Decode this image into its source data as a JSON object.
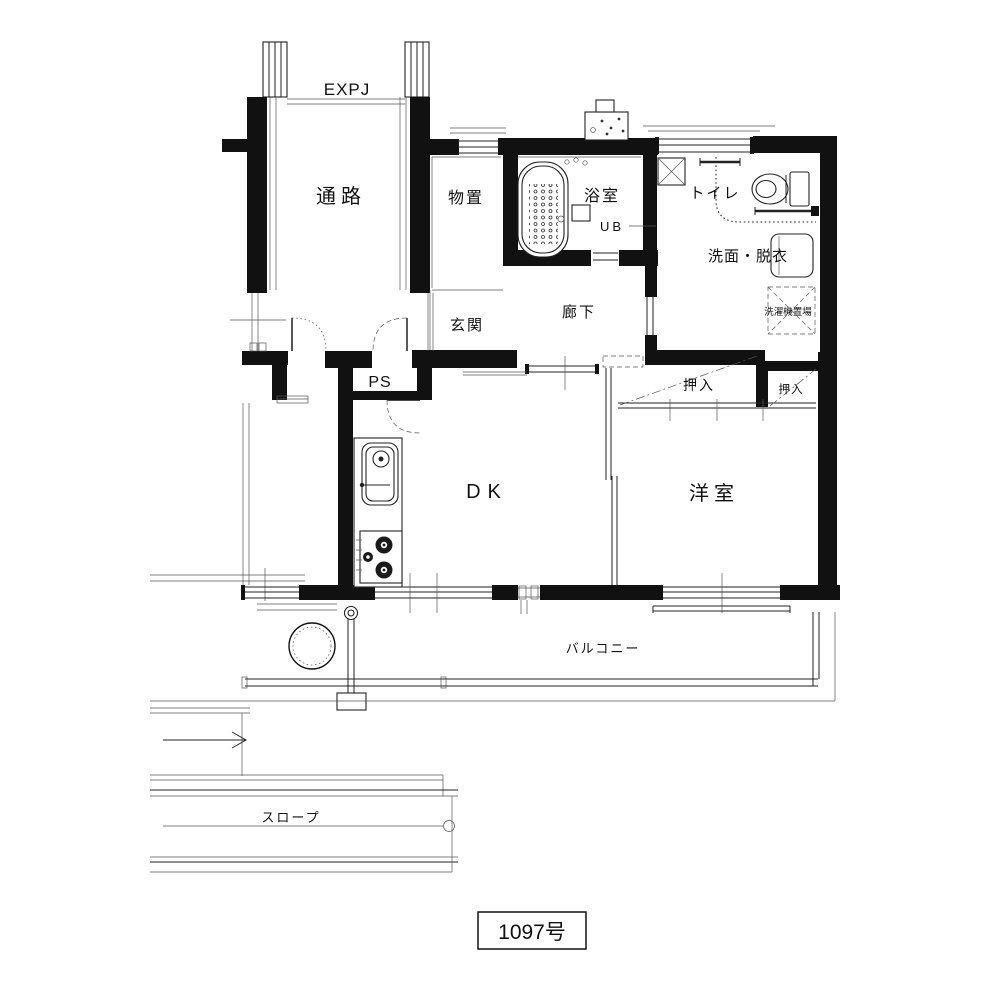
{
  "canvas": {
    "width": 1000,
    "height": 1000,
    "background": "#ffffff",
    "ink": "#111111"
  },
  "floor_plan": {
    "unit_label": "1097号",
    "annotations": {
      "expansion_joint": "EXPJ"
    },
    "rooms": {
      "passage": "通路",
      "storage": "物置",
      "bathroom": "浴室",
      "unit_bath": "UB",
      "toilet": "トイレ",
      "washroom": "洗面・脱衣",
      "washer_place": "洗濯機置場",
      "entrance": "玄関",
      "hallway": "廊下",
      "pipe_space": "PS",
      "closet_main": "押入",
      "closet_side": "押入",
      "dining_kitchen": "DK",
      "western_room": "洋室",
      "balcony": "バルコニー",
      "slope": "スロープ"
    }
  }
}
